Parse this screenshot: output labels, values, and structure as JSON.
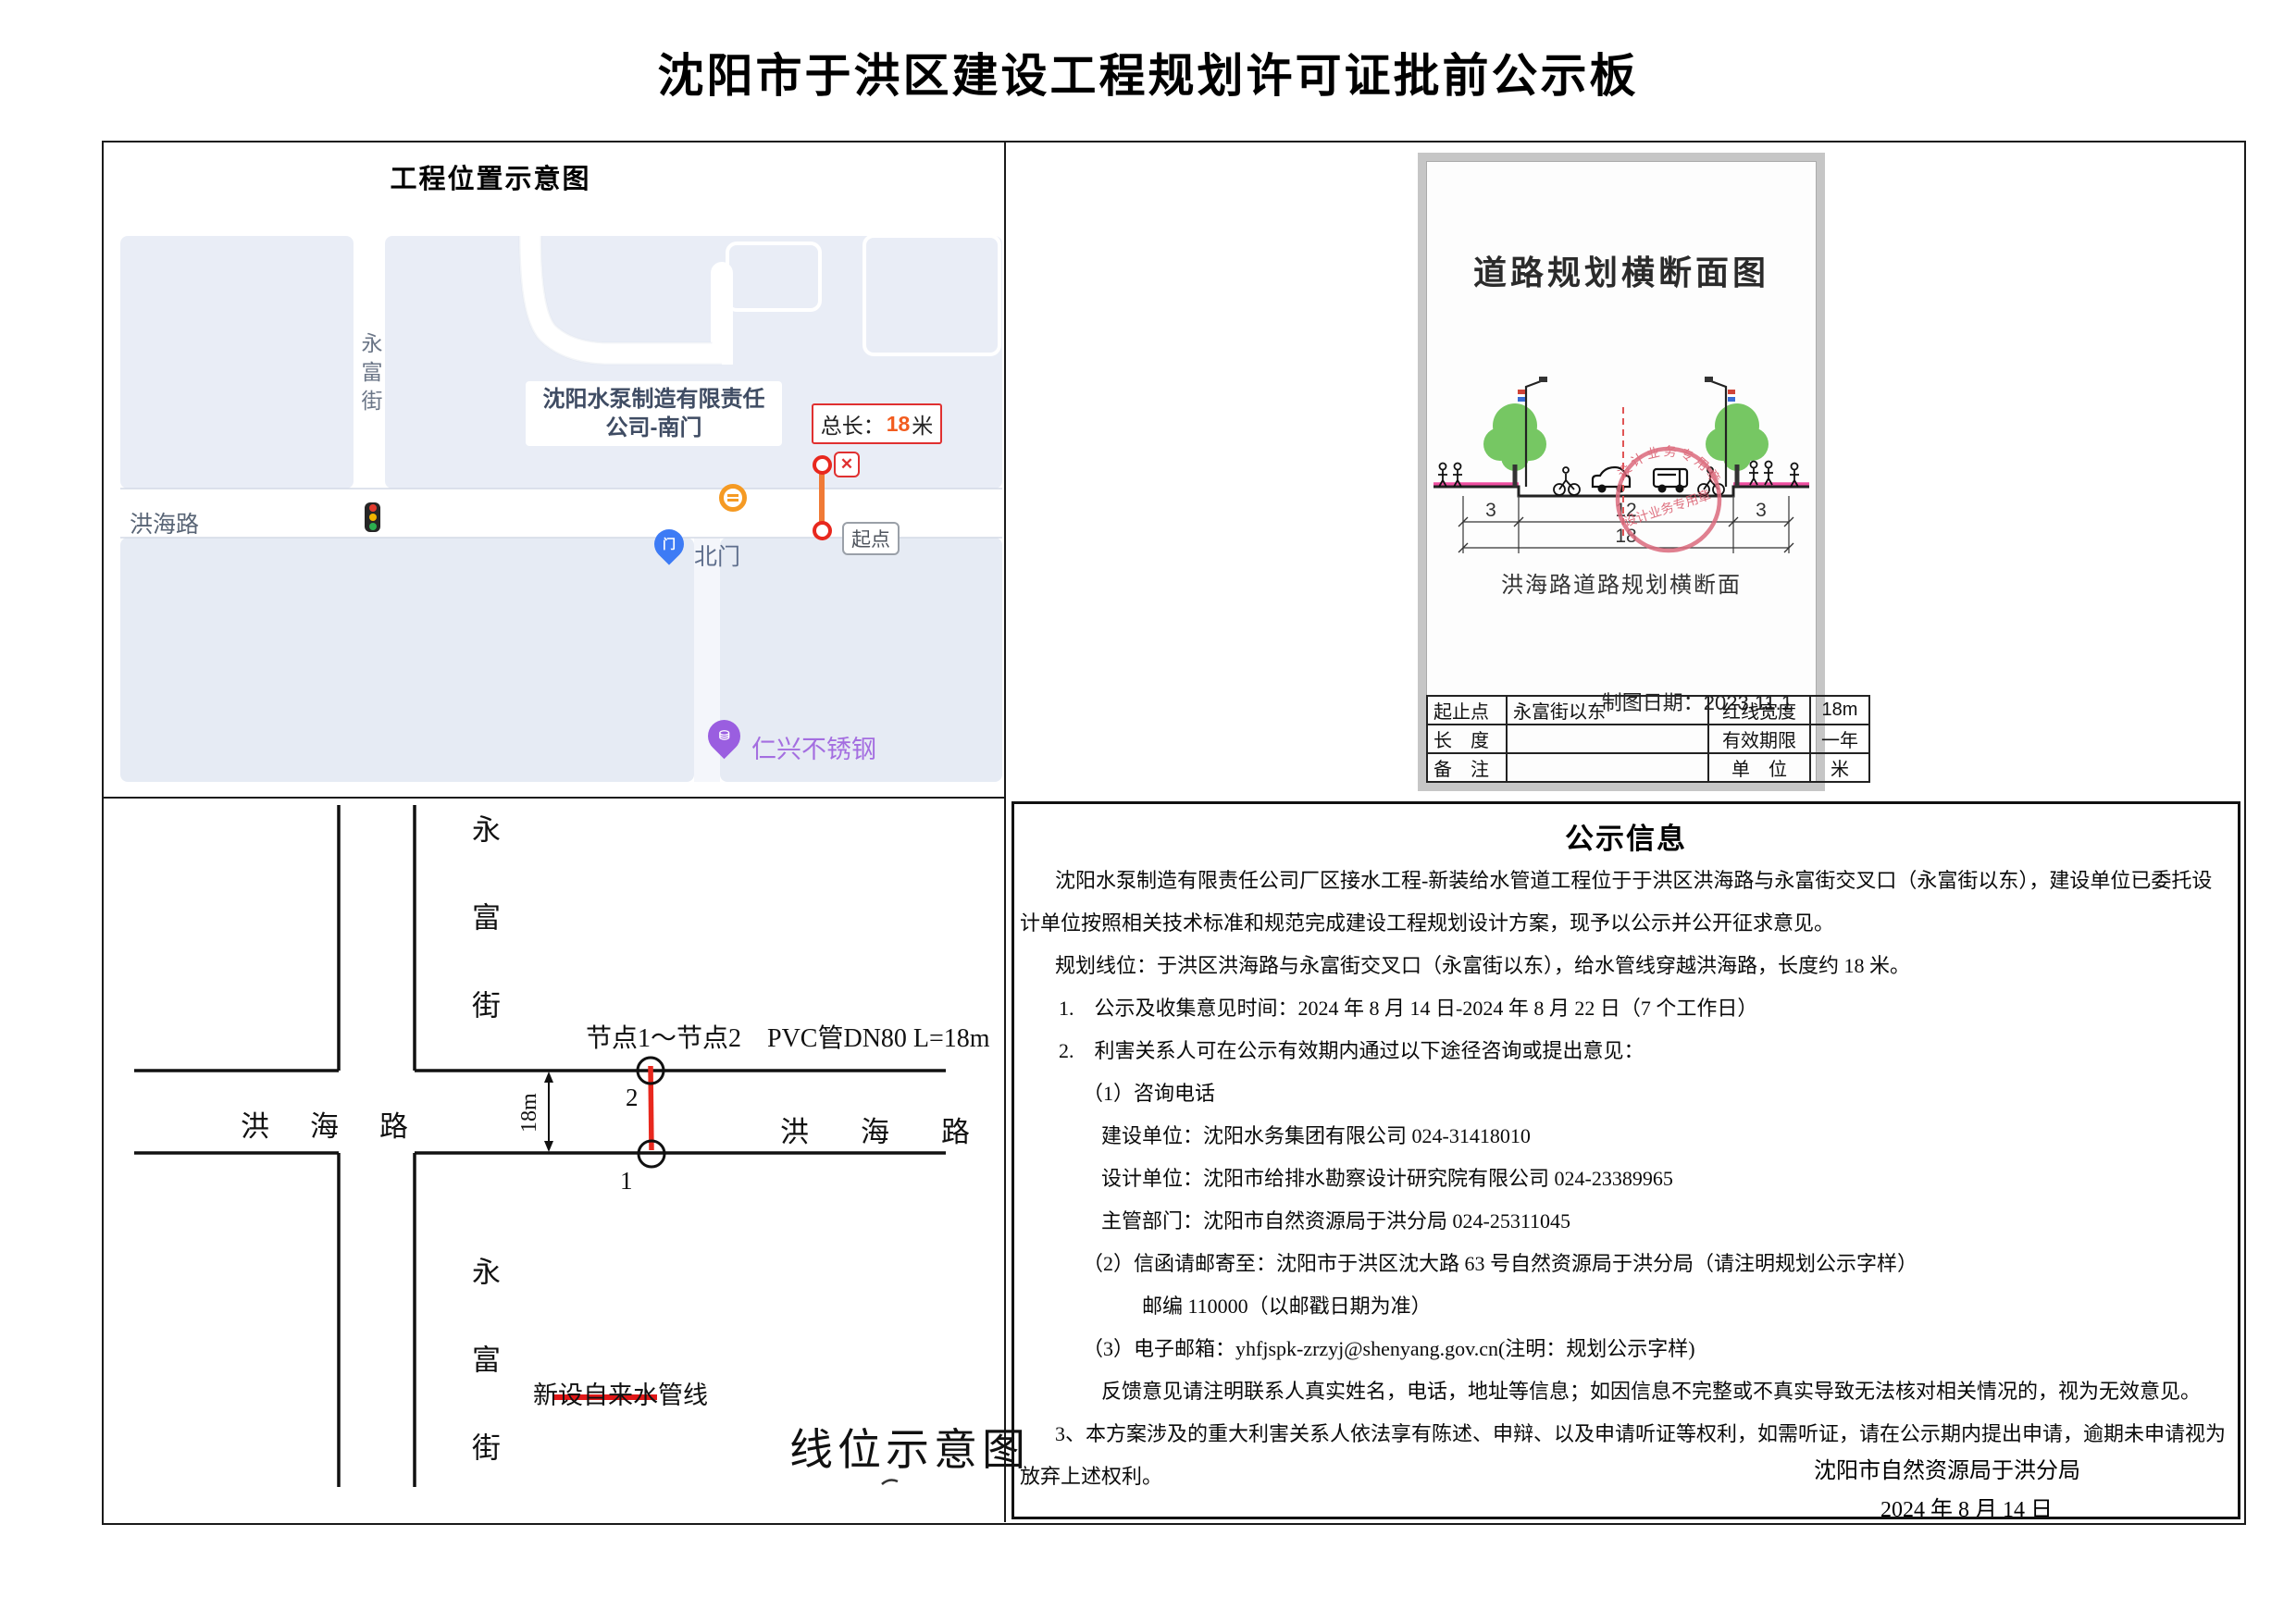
{
  "page": {
    "title": "沈阳市于洪区建设工程规划许可证批前公示板"
  },
  "colors": {
    "accent_red": "#e8281e",
    "route_orange": "#f07a36",
    "map_block": "#e9edf6",
    "pin_blue": "#3d7bf5",
    "pin_purple": "#9a5ee0",
    "sidewalk_pink": "#ee4fa0",
    "tree_green": "#76c763",
    "stamp_red": "#dc6b7e",
    "pipe_red": "#e01818"
  },
  "map": {
    "title": "工程位置示意图",
    "street": "永富街",
    "road": "洪海路",
    "company_line1": "沈阳水泵制造有限责任",
    "company_line2": "公司-南门",
    "length_prefix": "总长：",
    "length_value": "18",
    "length_unit": "米",
    "close_glyph": "✕",
    "start_label": "起点",
    "gate_glyph": "门",
    "gate_label": "北门",
    "shop_label": "仁兴不锈钢"
  },
  "cross": {
    "title": "道路规划横断面图",
    "caption": "洪海路道路规划横断面",
    "date": "制图日期：2023.11.1",
    "dim_left": "3",
    "dim_mid": "12",
    "dim_right": "3",
    "dim_total": "18",
    "stamp_text": "设计业务专用章",
    "table": [
      [
        "起止点",
        "永富街以东",
        "红线宽度",
        "18m"
      ],
      [
        "长　度",
        "",
        "有效期限",
        "一年"
      ],
      [
        "备　注",
        "",
        "单　位",
        "米"
      ]
    ]
  },
  "line": {
    "street_top": "永富街",
    "street_bottom": "永富街",
    "road_left": "洪海路",
    "road_right": "洪海路",
    "seg_label": "节点1～节点2　PVC管DN80 L=18m",
    "dim": "18m",
    "node_top": "2",
    "node_bottom": "1",
    "legend_label": "新设自来水管线",
    "title": "线位示意图"
  },
  "notice": {
    "title": "公示信息",
    "lines": [
      "沈阳水泵制造有限责任公司厂区接水工程-新装给水管道工程位于于洪区洪海路与永富街交叉口（永富街以东），建设单位已委托设",
      "计单位按照相关技术标准和规范完成建设工程规划设计方案，现予以公示并公开征求意见。",
      "规划线位：于洪区洪海路与永富街交叉口（永富街以东），给水管线穿越洪海路，长度约 18 米。",
      "1.　公示及收集意见时间：2024 年 8 月 14 日-2024 年 8 月 22 日（7 个工作日）",
      "2.　利害关系人可在公示有效期内通过以下途径咨询或提出意见：",
      "（1）咨询电话",
      "建设单位：沈阳水务集团有限公司 024-31418010",
      "设计单位：沈阳市给排水勘察设计研究院有限公司 024-23389965",
      "主管部门：沈阳市自然资源局于洪分局 024-25311045",
      "（2）信函请邮寄至：沈阳市于洪区沈大路 63 号自然资源局于洪分局（请注明规划公示字样）",
      "邮编 110000（以邮戳日期为准）",
      "（3）电子邮箱：yhfjspk-zrzyj@shenyang.gov.cn(注明：规划公示字样)",
      "反馈意见请注明联系人真实姓名，电话，地址等信息；如因信息不完整或不真实导致无法核对相关情况的，视为无效意见。",
      "3、本方案涉及的重大利害关系人依法享有陈述、申辩、以及申请听证等权利，如需听证，请在公示期内提出申请，逾期未申请视为",
      "放弃上述权利。"
    ],
    "signature": "沈阳市自然资源局于洪分局",
    "date": "2024 年 8 月 14 日"
  }
}
